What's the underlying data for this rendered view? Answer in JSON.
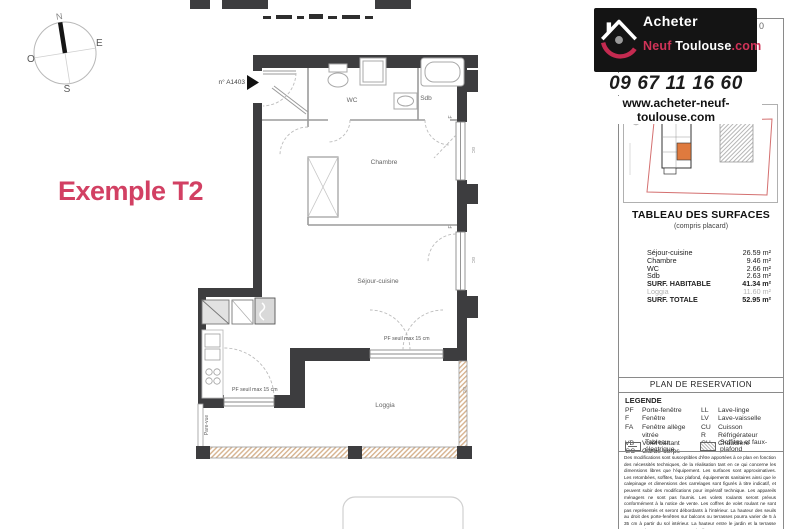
{
  "branding": {
    "logo_line1": "Acheter",
    "logo_neuf": "Neuf",
    "logo_toulouse": " Toulouse",
    "logo_com": ".com",
    "phone": "09 67 11 16 60",
    "website": "www.acheter-neuf-toulouse.com",
    "building_floor": "BATIMENT A - 14è ETAGE",
    "partial_digit": "0"
  },
  "plan": {
    "example_label": "Exemple T2",
    "unit_number": "n° A1403",
    "compass": {
      "north": "N",
      "east": "E",
      "south": "S",
      "west": "O"
    },
    "rooms": {
      "wc": "WC",
      "bathroom": "Sdb",
      "bedroom": "Chambre",
      "living_kitchen": "Séjour-cuisine",
      "loggia": "Loggia"
    },
    "annotations": {
      "pf_threshold": "PF seuil max 15 cm",
      "pare_vue": "Pare-vue",
      "window_label": "F",
      "guardrail_label": "GC"
    }
  },
  "surfaces_table": {
    "title": "TABLEAU DES SURFACES",
    "subtitle": "(compris placard)",
    "rows": [
      {
        "label": "Séjour-cuisine",
        "value": "26.59 m²",
        "style": "normal"
      },
      {
        "label": "Chambre",
        "value": "9.46 m²",
        "style": "normal"
      },
      {
        "label": "WC",
        "value": "2.66 m²",
        "style": "normal"
      },
      {
        "label": "Sdb",
        "value": "2.63 m²",
        "style": "normal"
      },
      {
        "label": "SURF. HABITABLE",
        "value": "41.34 m²",
        "style": "bold"
      },
      {
        "label": "Loggia",
        "value": "11.60 m²",
        "style": "muted"
      },
      {
        "label": "SURF. TOTALE",
        "value": "52.95 m²",
        "style": "bold"
      }
    ]
  },
  "reservation": {
    "title": "PLAN DE RESERVATION"
  },
  "legend": {
    "title": "LEGENDE",
    "left": [
      {
        "abbr": "PF",
        "label": "Porte-fenêtre"
      },
      {
        "abbr": "F",
        "label": "Fenêtre"
      },
      {
        "abbr": "FA",
        "label": "Fenêtre allège vitrée"
      },
      {
        "abbr": "VB",
        "label": "Volet battant"
      },
      {
        "abbr": "GC",
        "label": "Garde-corps"
      }
    ],
    "right": [
      {
        "abbr": "LL",
        "label": "Lave-linge"
      },
      {
        "abbr": "LV",
        "label": "Lave-vaisselle"
      },
      {
        "abbr": "CU",
        "label": "Cuisson"
      },
      {
        "abbr": "R",
        "label": "Réfrigérateur"
      },
      {
        "abbr": "CH",
        "label": "Chaudière"
      }
    ],
    "electrical_panel": "Tableau électrique",
    "soffits": "Soffites et faux-plafond"
  },
  "disclaimer": "Des modifications sont susceptibles d'être apportées à ce plan en fonction des nécessités techniques, de la réalisation tant en ce qui concerne les dimensions libres que l'équipement. Les surfaces sont approximatives. Les retombées, soffites, faux plafond, équipements sanitaires ainsi que le calepinage et dimensions des carrelages sont figurés à titre indicatif, et peuvent subir des modifications pour impératif technique. Les appareils ménagers ne sont pas fournis. Les volets roulants seront prévus conformément à la notice de vente. Les coffres de volet roulant ne sont pas représentés et seront débordants à l'intérieur. La hauteur des seuils au droit des porte-fenêtres sur balcons ou terrasses pourra varier de 5 à 35 cm à partir du sol intérieur. La hauteur entre le jardin et la terrasse pourra varier entre 0 et 60 cm. Les jardins ne seront pas",
  "colors": {
    "accent_pink": "#d24063",
    "wall_dark": "#3d3d3f",
    "site_boundary": "#d47070",
    "unit_highlight": "#df7a3e"
  }
}
